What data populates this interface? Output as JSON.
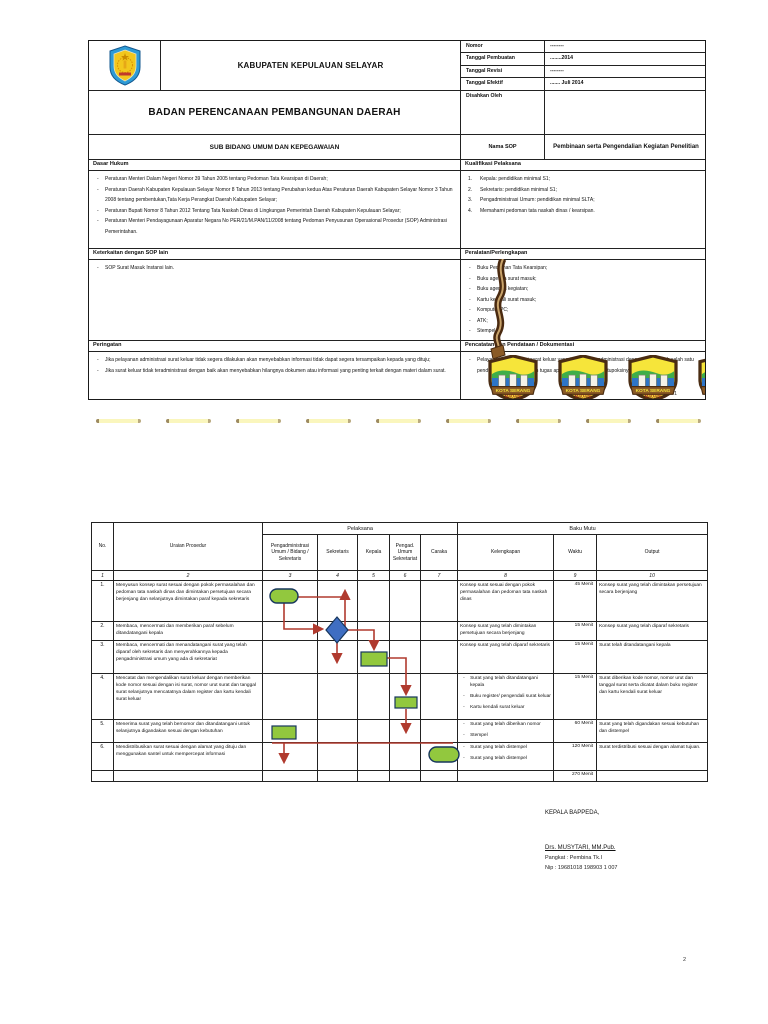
{
  "page1": {
    "logo": "kabupaten-selayar-crest-icon",
    "kabupaten": "KABUPATEN KEPULAUAN SELAYAR",
    "badan": "BADAN PERENCANAAN PEMBANGUNAN DAERAH",
    "sub_bidang": "SUB BIDANG UMUM DAN KEPEGAWAIAN",
    "meta": {
      "nomor_label": "Nomor",
      "nomor_value": "--------",
      "tgl_pembuatan_label": "Tanggal Pembuatan",
      "tgl_pembuatan_value": "........2014",
      "tgl_revisi_label": "Tanggal Revisi",
      "tgl_revisi_value": "--------",
      "tgl_efektif_label": "Tanggal Efektif",
      "tgl_efektif_value": "....... Juli 2014",
      "disahkan_label": "Disahkan Oleh",
      "nama_sop_label": "Nama SOP",
      "nama_sop_value": "Pembinaan serta Pengendalian Kegiatan Penelitian"
    },
    "dasar_hukum": {
      "title": "Dasar Hukum",
      "items": [
        "Peraturan Menteri Dalam Negeri Nomor 39 Tahun 2005 tentang Pedoman Tata Kearsipan di Daerah;",
        "Peraturan Daerah Kabupaten Kepulauan Selayar Nomor 8 Tahun 2013 tentang Perubahan kedua Atas Peraturan Daerah Kabupaten Selayar Nomor 3 Tahun 2008 tentang pembentukan,Tata Kerja Perangkat Daerah Kabupaten Selayar;",
        "Peraturan Bupati Nomor 8 Tahun 2012 Tentang Tata Naskah Dinas di Lingkungan Pemerintah Daerah Kabupaten Kepulauan Selayar;",
        "Peraturan Menteri Pendayagunaan Aparatur Negara No PER/21/M.PAN/11/2008 tentang Pedoman Penyusunan Operasional Prosedur (SOP) Administrasi Pemerintahan."
      ]
    },
    "kualifikasi": {
      "title": "Kualifikasi Pelaksana",
      "items": [
        "Kepala: pendidikan minimal S1;",
        "Sekretaris: pendidikan minimal S1;",
        "Pengadministrasi Umum: pendidikan minimal SLTA;",
        "Memahami pedoman tata naskah dinas / kearsipan."
      ]
    },
    "keterkaitan": {
      "title": "Keterkaitan dengan SOP lain",
      "items": [
        "SOP Surat Masuk Instansi lain."
      ]
    },
    "peralatan": {
      "title": "Peralatan/Perlengkapan",
      "items": [
        "Buku Pedoman Tata Kearsipan;",
        "Buku agenda surat masuk;",
        "Buku agenda kegiatan;",
        "Kartu kendali surat masuk;",
        "Komputer/PC;",
        "ATK;",
        "Stempel."
      ]
    },
    "peringatan": {
      "title": "Peringatan",
      "items": [
        "Jika pelayanan administrasi surat keluar tidak segera dilakukan akan menyebabkan informasi tidak dapat segera tersampaikan kepada yang dituju;",
        "Jika surat keluar tidak teradministrasi dengan baik akan menyebabkan hilangnya dokumen atau informasi yang penting terkait dengan materi dalam surat."
      ]
    },
    "pencatatan": {
      "title": "Pencatatan dan Pendataan / Dokumentasi",
      "items": [
        "Pelayanan administrasi surat keluar yang tertib dan teradministrasi dengan baik adalah salah satu pendukung bagi kelancaran tugas aparatur sesuai dengan tupoksinya."
      ]
    },
    "watermark": {
      "line1": "KOTA SERANG",
      "line2": "MADANI"
    },
    "page_number": "1"
  },
  "page2": {
    "table": {
      "group_pelaksana": "Pelaksana",
      "group_baku_mutu": "Baku Mutu",
      "columns": [
        "No.",
        "Uraian Prosedur",
        "Pengadministrasi Umum / Bidang / Sekretaris",
        "Sekretaris",
        "Kepala",
        "Pengad. Umum Sekretariat",
        "Caraka",
        "Kelengkapan",
        "Waktu",
        "Output"
      ],
      "column_numbers": [
        "1",
        "2",
        "3",
        "4",
        "5",
        "6",
        "7",
        "8",
        "9",
        "10"
      ],
      "rows": [
        {
          "no": "1.",
          "uraian": "Menyusun konsep surat sesuai dengan pokok permasalahan dan pedoman tata naskah dinas dan dimintakan persetujuan secara berjenjang dan selanjutnya dimintakan paraf kepada sekretaris",
          "kelengkapan": [
            "Konsep surat sesuai dengan pokok permasalahan dan pedoman tata naskah dinas"
          ],
          "waktu": "45 Menit",
          "output": "Konsep surat yang telah dimintakan persetujuan secara berjenjang",
          "flow_shape": "start-terminator"
        },
        {
          "no": "2.",
          "uraian": "Membaca, mencermati dan memberikan paraf sebelum ditandatangani kepala",
          "kelengkapan": [
            "Konsep surat yang telah dimintakan persetujuan secara berjenjang"
          ],
          "waktu": "15 Menit",
          "output": "Konsep surat yang telah diparaf sekretaris",
          "flow_shape": "decision-diamond"
        },
        {
          "no": "3.",
          "uraian": "Membaca, mencermati dan menandatangani surat yang telah diparaf oleh sekretaris dan menyerahkannya kepada pengadministrasi umum yang ada di sekretariat",
          "kelengkapan": [
            "Konsep surat yang telah diparaf sekretaris"
          ],
          "waktu": "15 Menit",
          "output": "Surat telah ditandatangani kepala",
          "flow_shape": "process-box"
        },
        {
          "no": "4.",
          "uraian": "Mencatat dan mengendalikan surat keluar dengan memberikan kode nomor sesuai dengan isi surat, nomor urut surat dan tanggal surat selanjutnya mencatatnya dalam register dan kartu kendali surat keluar",
          "kelengkapan": [
            "Surat yang telah ditandatangani kepala",
            "Buku register/ pengendali surat keluar",
            "Kartu kendali surat keluar"
          ],
          "waktu": "15 Menit",
          "output": "Surat diberikan kode nomor, nomor urut dan tanggal surat serta dicatat dalam buku register dan kartu kendali surat keluar",
          "flow_shape": "process-box"
        },
        {
          "no": "5.",
          "uraian": "Menerima surat yang telah bernomor dan ditandatangani untuk selanjutnya digandakan sesuai dengan kebutuhan",
          "kelengkapan": [
            "Surat yang telah diberikan nomor",
            "Stempel"
          ],
          "waktu": "60 Menit",
          "output": "Surat yang telah digandakan sesuai kebutuhan dan distempel",
          "flow_shape": "process-box"
        },
        {
          "no": "6.",
          "uraian": "Mendistribusikan surat sesuai dengan alamat yang dituju dan menggunakan santel untuk mempercepat informasi",
          "kelengkapan": [
            "Surat yang telah distempel",
            "Surat yang telah distempel"
          ],
          "waktu": "120 Menit",
          "output": "Surat terdistribusi sesuai dengan alamat tujuan.",
          "flow_shape": "end-terminator"
        }
      ],
      "total_waktu": "270 Menit"
    },
    "flowchart": {
      "shapes": [
        {
          "step": 1,
          "type": "terminator-start",
          "lane": "Pengadministrasi Umum / Bidang / Sekretaris"
        },
        {
          "step": 2,
          "type": "decision",
          "lane": "Sekretaris"
        },
        {
          "step": 3,
          "type": "process",
          "lane": "Kepala"
        },
        {
          "step": 4,
          "type": "process",
          "lane": "Pengad. Umum Sekretariat"
        },
        {
          "step": 5,
          "type": "process",
          "lane": "Pengadministrasi Umum / Bidang / Sekretaris"
        },
        {
          "step": 6,
          "type": "terminator-end",
          "lane": "Caraka"
        }
      ],
      "colors": {
        "shape_green": "#92c83e",
        "decision_blue": "#3f6ec2",
        "connector_red": "#b03a2e"
      }
    },
    "signature": {
      "title": "KEPALA BAPPEDA,",
      "name": "Drs. MUSYTARI, MM.Pub.",
      "pangkat": "Pangkat : Pembina Tk.I",
      "nip": "Nip :  19681018 198903 1 007"
    },
    "page_number": "2"
  }
}
